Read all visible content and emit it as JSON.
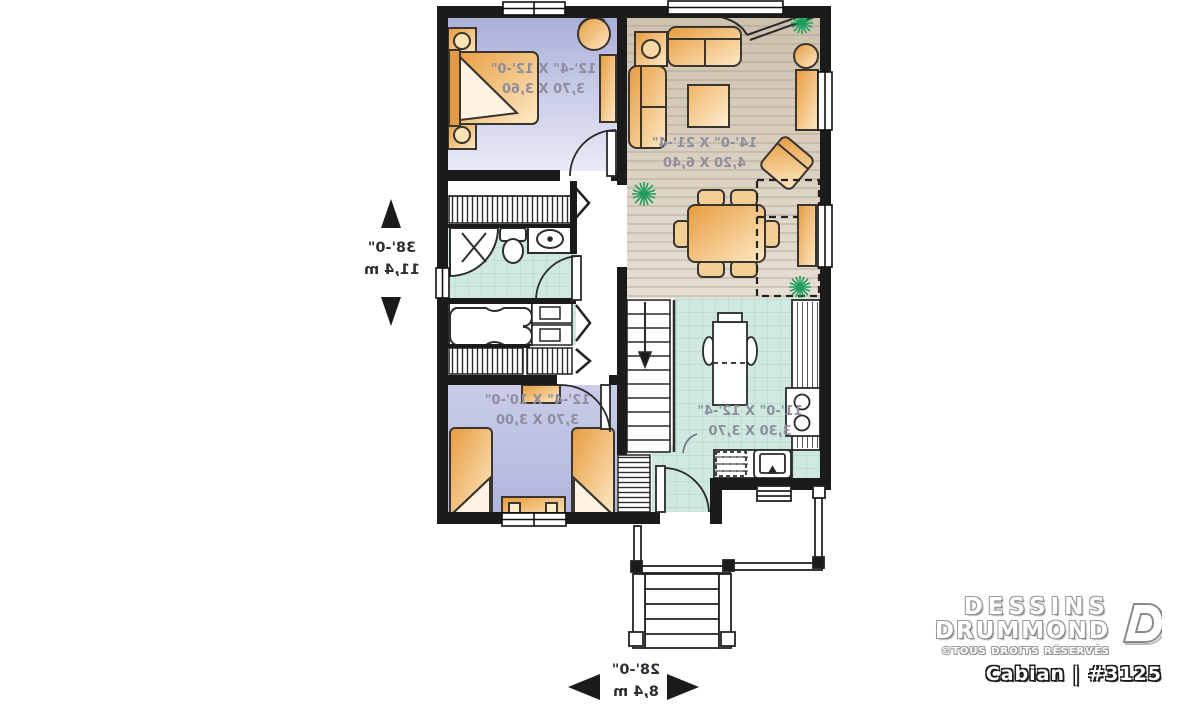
{
  "brand": {
    "line1": "DESSINS",
    "line2": "DRUMMOND",
    "copyright": "©TOUS DROITS RÉSERVÉS",
    "model": "Cabian | #3125"
  },
  "dimensions": {
    "vertical": {
      "imperial": "38'-0\"",
      "metric": "11,4 m"
    },
    "horizontal": {
      "imperial": "28'-0\"",
      "metric": "8,4 m"
    }
  },
  "rooms": {
    "bedroom1": {
      "imperial": "12'-4\" X 12'-0\"",
      "metric": "3,70 X 3,60"
    },
    "living": {
      "imperial": "14'-0\" X 21'-4\"",
      "metric": "4,20 X 6,40"
    },
    "bedroom2": {
      "imperial": "12'-4\" X 10'-0\"",
      "metric": "3,70 X 3,00"
    },
    "kitchen": {
      "imperial": "11'-0\" X 12'-4\"",
      "metric": "3,30 X 3,70"
    }
  },
  "colors": {
    "wall": "#1b1b1b",
    "bedroom_floor": "#b2b6dd",
    "wood_floor": "#d7cdbf",
    "tile_floor": "#cfe9e0",
    "furniture": "#eaa554",
    "plant": "#1f9e60",
    "room_label": "#8e8e9e"
  }
}
